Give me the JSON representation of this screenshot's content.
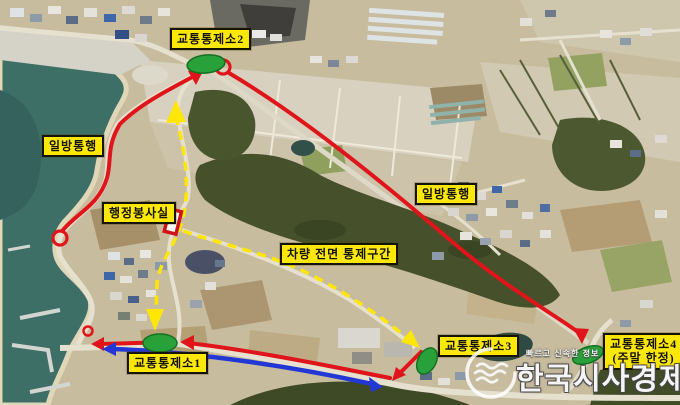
{
  "map_labels": {
    "control_post_2": "교통통제소2",
    "one_way_left": "일방통행",
    "admin_service_office": "행정봉사실",
    "vehicle_full_control_zone": "차량 전면 통제구간",
    "one_way_right": "일방통행",
    "control_post_1": "교통통제소1",
    "control_post_3": "교통통제소3",
    "control_post_4_line1": "교통통제소4",
    "control_post_4_line2": "(주말 한정)"
  },
  "watermark": {
    "tagline": "빠르고 신속한 정보",
    "brand": "한국시사경제"
  },
  "colors": {
    "label_bg": "#ffe800",
    "route_red": "#e0151b",
    "route_blue": "#2237d4",
    "dashed_yellow": "#ffe603",
    "control_point_green": "#29a13a"
  }
}
